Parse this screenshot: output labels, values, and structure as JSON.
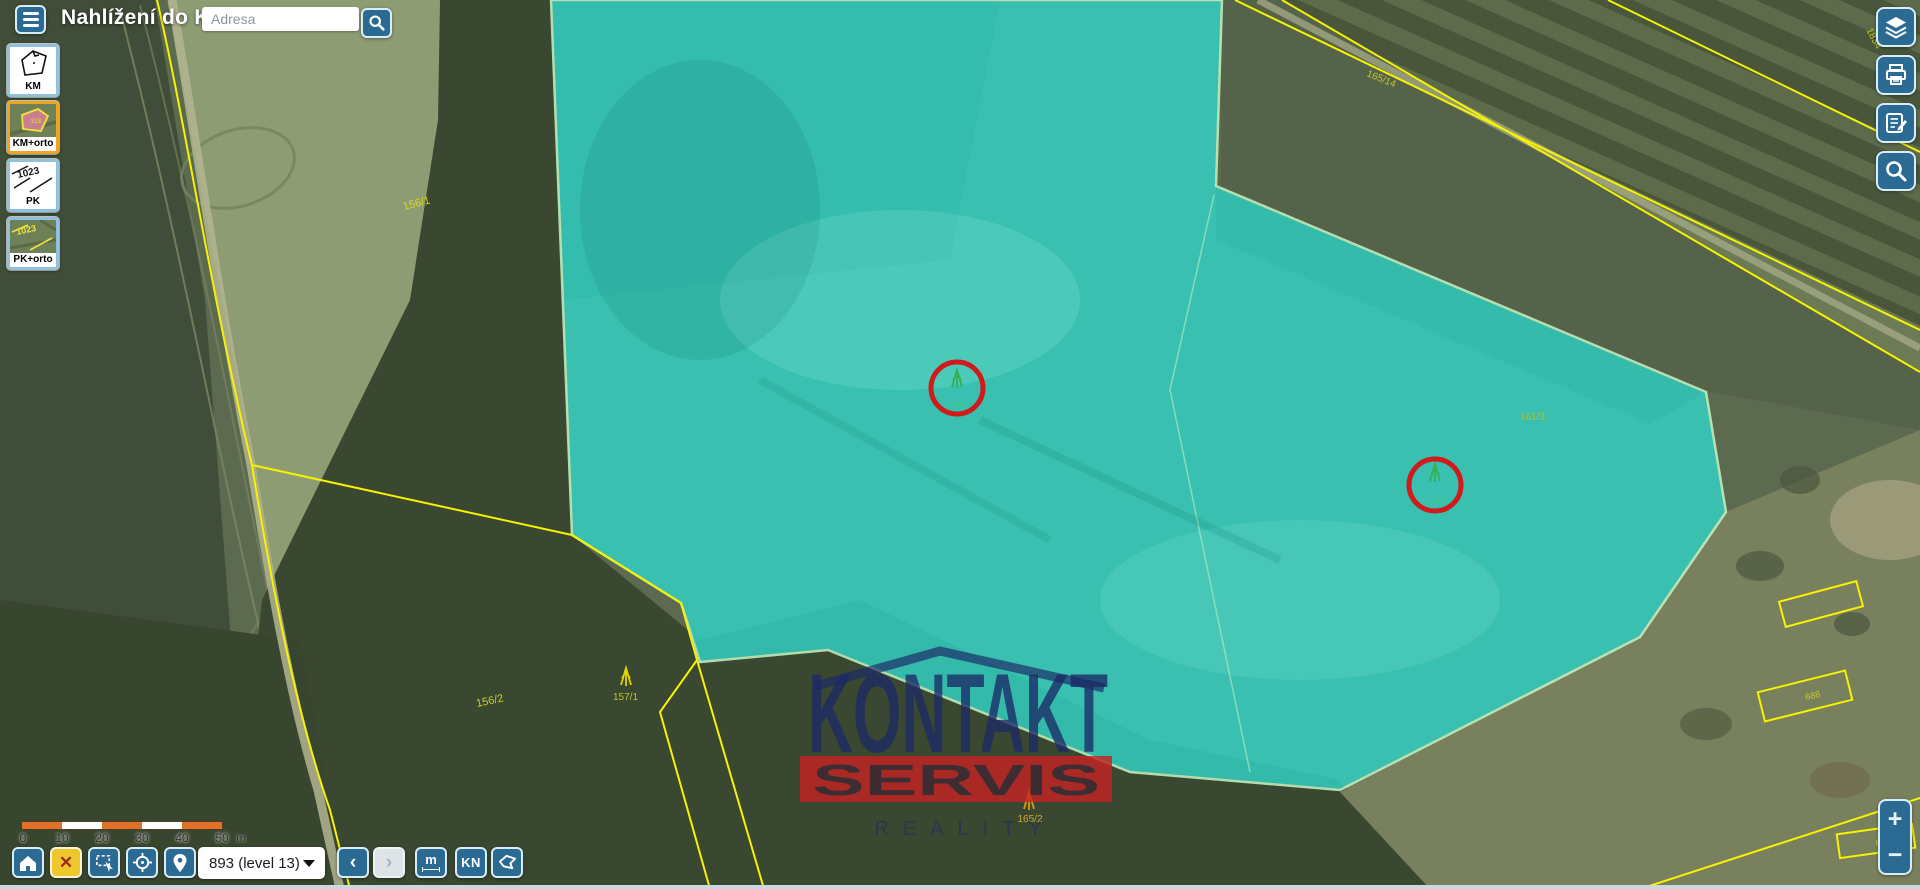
{
  "header": {
    "title": "Nahlížení do KN",
    "search": {
      "placeholder": "Adresa"
    },
    "icons": {
      "menu": "hamburger-icon",
      "search": "magnifier-icon"
    }
  },
  "layer_switcher": {
    "items": [
      {
        "label": "KM",
        "active": false
      },
      {
        "label": "KM+orto",
        "active": true
      },
      {
        "label": "PK",
        "active": false
      },
      {
        "label": "PK+orto",
        "active": false
      }
    ]
  },
  "right_toolbar": {
    "buttons": [
      {
        "icon": "layers-icon"
      },
      {
        "icon": "printer-icon"
      },
      {
        "icon": "notes-icon"
      },
      {
        "icon": "magnifier-icon"
      }
    ]
  },
  "zoom_control": {
    "zoom_in": "+",
    "zoom_out": "−"
  },
  "scale_bar": {
    "ticks": [
      "0",
      "10",
      "20",
      "30",
      "40",
      "50"
    ],
    "unit": "m"
  },
  "bottom_toolbar": {
    "close_label": "✕",
    "zoom_level_value": "893 (level 13)",
    "back_label": "‹",
    "forward_label": "›",
    "measure_label": "m",
    "kn_label": "KN"
  },
  "map": {
    "watermark": {
      "line1": "KONTAKT",
      "line2": "SERVIS",
      "line3": "REALITY"
    },
    "selected_parcel_labels": [
      "160/1",
      "160/2"
    ],
    "labels": [
      {
        "text": "156/1"
      },
      {
        "text": "165/14"
      },
      {
        "text": "1834"
      },
      {
        "text": "161/3"
      },
      {
        "text": "156/2"
      },
      {
        "text": "157/1"
      },
      {
        "text": "165/2"
      },
      {
        "text": "688"
      },
      {
        "text": "660"
      }
    ]
  },
  "colors": {
    "toolbar_button_blue": "#2b6b93",
    "selected_parcel_cyan": "#33cfc1",
    "parcel_line_yellow": "#f6f200",
    "poi_circle_red": "#d11a1a",
    "active_layer_border_orange": "#eda41e",
    "close_button_yellow": "#eec72c",
    "watermark_navy": "#1c2a66",
    "watermark_red": "#c32222"
  }
}
